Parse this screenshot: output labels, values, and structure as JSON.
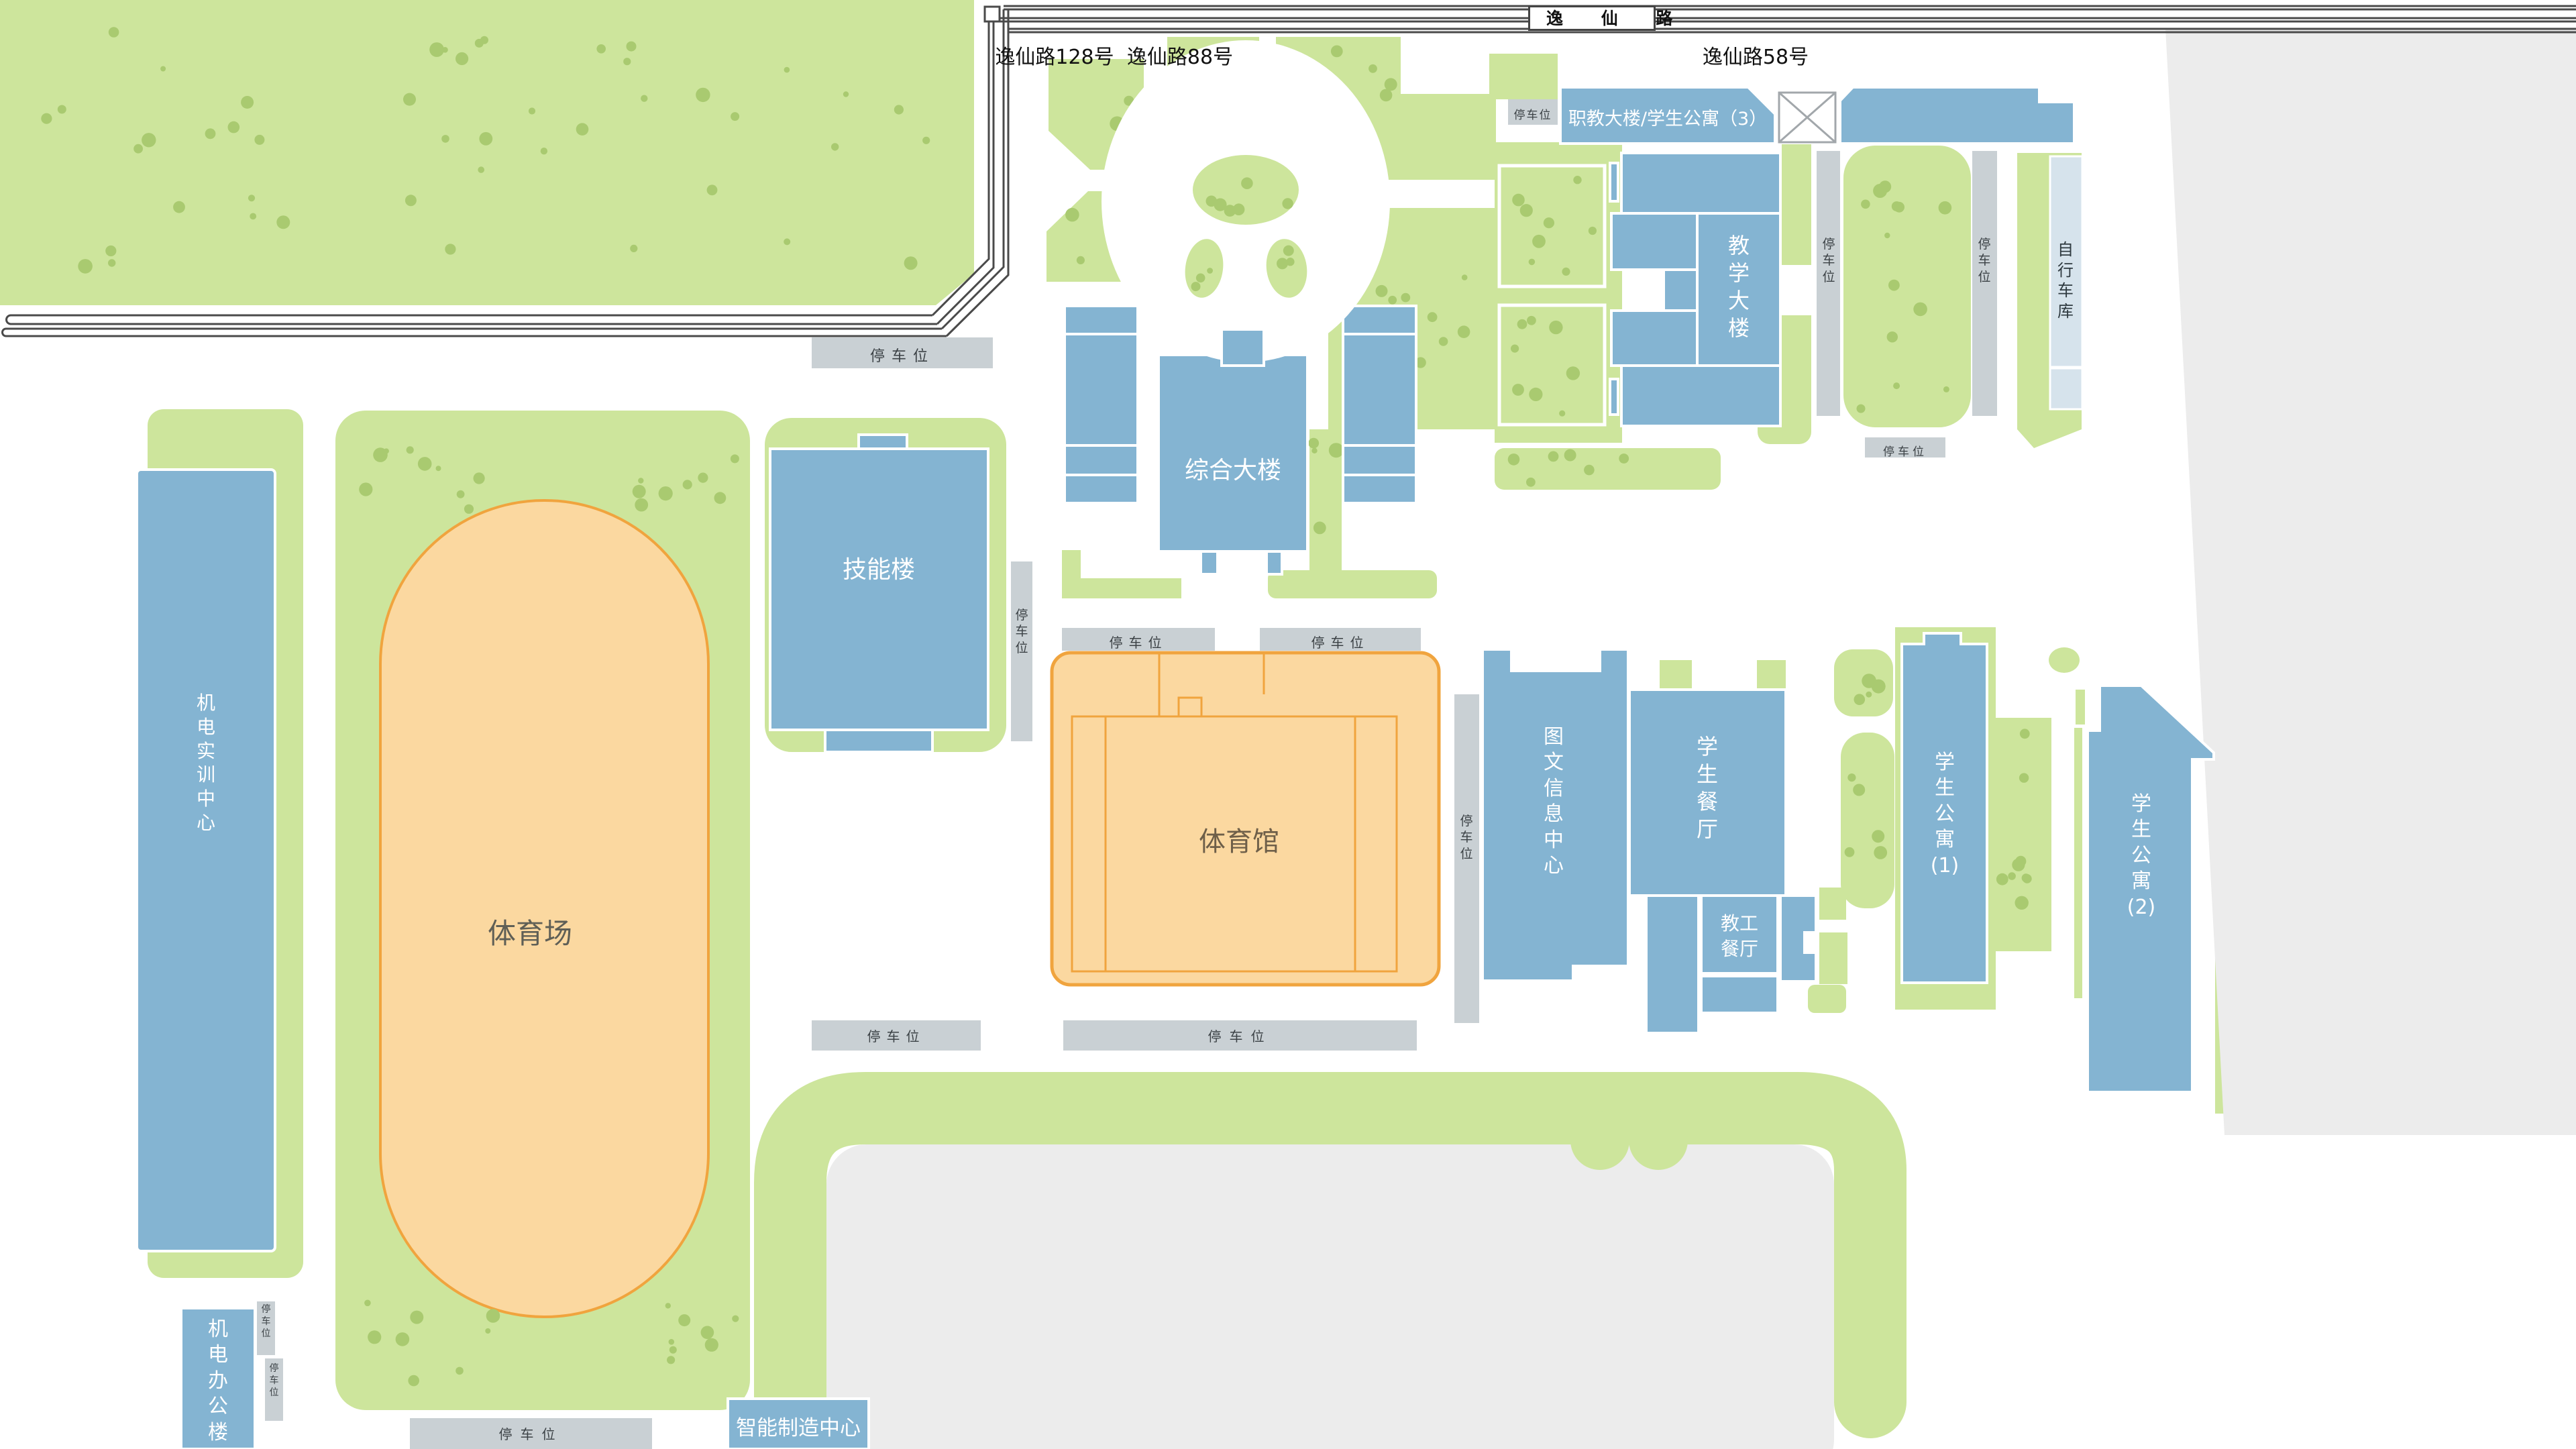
{
  "road": {
    "label": "逸 仙 路"
  },
  "addresses": [
    {
      "label": "逸仙路128号"
    },
    {
      "label": "逸仙路88号"
    },
    {
      "label": "逸仙路58号"
    }
  ],
  "parking_label": "停车位",
  "buildings": {
    "zhijiao": {
      "label": "职教大楼/学生公寓（3）"
    },
    "jiaoxue": {
      "label": "教学大楼"
    },
    "zonghe": {
      "label": "综合大楼"
    },
    "jineng": {
      "label": "技能楼"
    },
    "jidian_shixun": {
      "label": "机电实训中心"
    },
    "jidian_bangong": {
      "label": "机电办公楼"
    },
    "zhineng": {
      "label": "智能制造中心"
    },
    "tuwen": {
      "label": "图文信息中心"
    },
    "xuesheng_canting": {
      "label": "学生餐厅"
    },
    "jiaogong_canting": {
      "label": "教工餐厅"
    },
    "gongyu1": {
      "label": "学生公寓(1)"
    },
    "gongyu2": {
      "label": "学生公寓(2)"
    },
    "zixingche": {
      "label": "自行车库"
    },
    "tiyuchang": {
      "label": "体育场"
    },
    "tiyuguan": {
      "label": "体育馆"
    }
  },
  "colors": {
    "green": "#cde59c",
    "dot": "#a9ca70",
    "blue": "#84b4d2",
    "parking_gray": "#c9d0d4",
    "area_gray": "#ececec",
    "track_fill": "#fbd8a0",
    "track_line": "#f0a43e",
    "bike_fill": "#d6e3ec",
    "road_line": "#4a4a4a"
  }
}
